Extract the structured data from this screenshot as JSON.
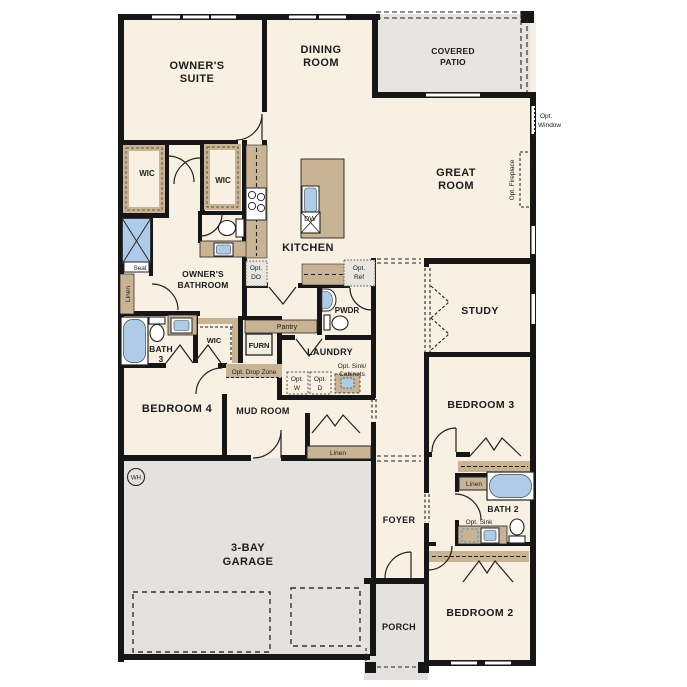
{
  "plan_title": "Single-story home floor plan",
  "colors": {
    "floor": "#f8f0e2",
    "wall": "#161616",
    "garage_gray": "#e3e2de",
    "patio_gray": "#e6e5e1",
    "counter_tan": "#c8b495",
    "fixture_blue": "#aecbe8",
    "window_white": "#ffffff"
  },
  "rooms": {
    "owners_suite": [
      "OWNER'S",
      "SUITE"
    ],
    "dining_room": [
      "DINING",
      "ROOM"
    ],
    "covered_patio": [
      "COVERED",
      "PATIO"
    ],
    "great_room": [
      "GREAT",
      "ROOM"
    ],
    "kitchen": "KITCHEN",
    "owners_bathroom": [
      "OWNER'S",
      "BATHROOM"
    ],
    "bath_3": [
      "BATH",
      "3"
    ],
    "bedroom_4": "BEDROOM 4",
    "mud_room": "MUD ROOM",
    "laundry": "LAUNDRY",
    "pantry": "Pantry",
    "powder": "PWDR",
    "study": "STUDY",
    "bedroom_3": "BEDROOM 3",
    "bath_2": "BATH 2",
    "bedroom_2": "BEDROOM 2",
    "foyer": "FOYER",
    "porch": "PORCH",
    "garage": [
      "3-BAY",
      "GARAGE"
    ]
  },
  "labels": {
    "wic": "WIC",
    "seat": "Seat",
    "linen": "Linen",
    "furn": "FURN",
    "dw": "DW",
    "wh": "WH",
    "opt_do": [
      "Opt.",
      "DO"
    ],
    "opt_ref": [
      "Opt.",
      "Ref"
    ],
    "opt_window": [
      "Opt.",
      "Window"
    ],
    "opt_fireplace": "Opt. Fireplace",
    "opt_drop_zone": "Opt. Drop Zone",
    "opt_sink_cabinets": [
      "Opt. Sink/",
      "Cabinets"
    ],
    "opt_w": [
      "Opt.",
      "W"
    ],
    "opt_d": [
      "Opt.",
      "D"
    ],
    "opt_sink": "Opt. Sink"
  }
}
